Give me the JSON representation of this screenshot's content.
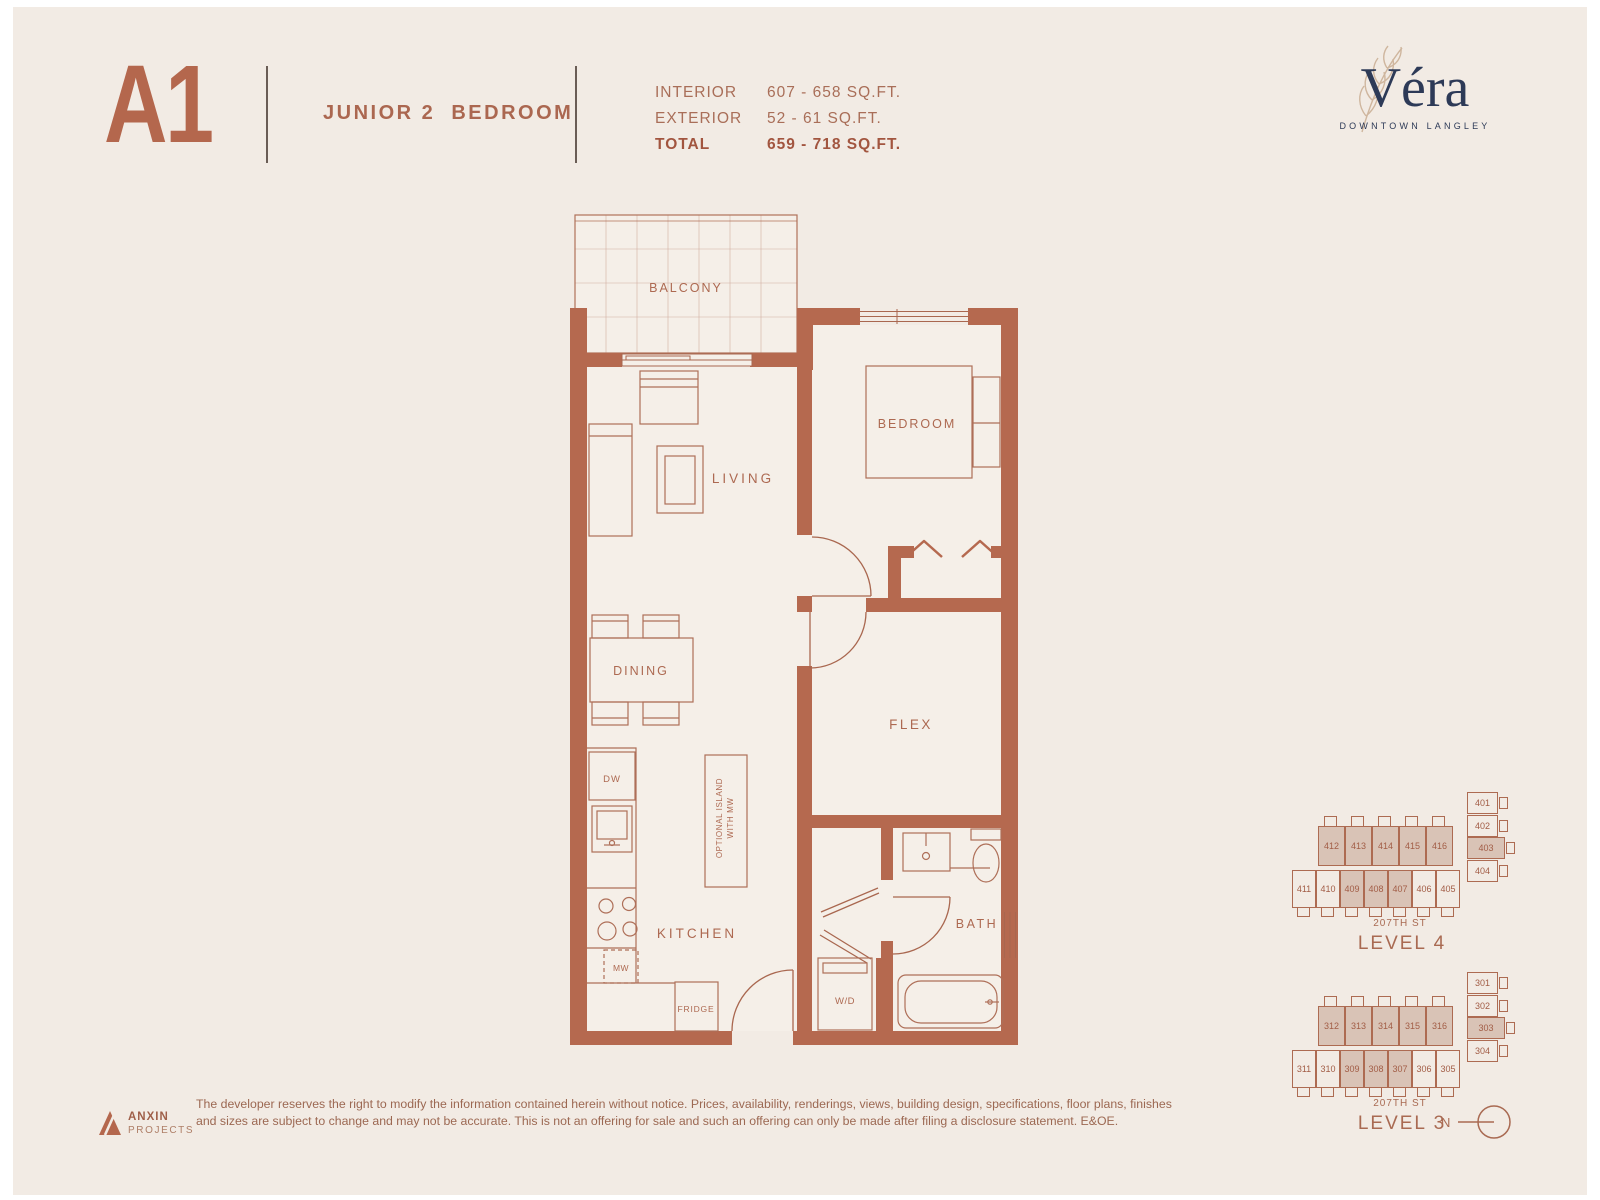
{
  "header": {
    "plan_code": "A1",
    "plan_type": "JUNIOR 2  BEDROOM",
    "areas": [
      {
        "label": "INTERIOR",
        "value": "607 - 658  SQ.FT."
      },
      {
        "label": "EXTERIOR",
        "value": "52 - 61  SQ.FT."
      },
      {
        "label": "TOTAL",
        "value": "659 - 718  SQ.FT."
      }
    ]
  },
  "brand": {
    "name": "Véra",
    "tagline": "DOWNTOWN LANGLEY"
  },
  "colors": {
    "accent_terracotta": "#b5694f",
    "navy": "#2d3a57",
    "unit_shade": "#d9c3b6",
    "background": "#f2ebe4"
  },
  "floorplan": {
    "labels": {
      "balcony": "BALCONY",
      "living": "LIVING",
      "bedroom": "BEDROOM",
      "dining": "DINING",
      "flex": "FLEX",
      "kitchen": "KITCHEN",
      "bath": "BATH",
      "dishwasher": "DW",
      "microwave": "MW",
      "fridge": "FRIDGE",
      "washer_dryer": "W/D",
      "island_line1": "OPTIONAL ISLAND",
      "island_line2": "WITH MW"
    }
  },
  "keyplans": [
    {
      "level": "LEVEL 4",
      "street": "207TH ST",
      "top_row": [
        {
          "num": "412",
          "shaded": true
        },
        {
          "num": "413",
          "shaded": true
        },
        {
          "num": "414",
          "shaded": true
        },
        {
          "num": "415",
          "shaded": true
        },
        {
          "num": "416",
          "shaded": true
        }
      ],
      "right_col": [
        {
          "num": "401",
          "shaded": false
        },
        {
          "num": "402",
          "shaded": false
        },
        {
          "num": "403",
          "shaded": true
        },
        {
          "num": "404",
          "shaded": false
        }
      ],
      "bottom_row": [
        {
          "num": "411",
          "shaded": false
        },
        {
          "num": "410",
          "shaded": false
        },
        {
          "num": "409",
          "shaded": true
        },
        {
          "num": "408",
          "shaded": true
        },
        {
          "num": "407",
          "shaded": true
        },
        {
          "num": "406",
          "shaded": false
        },
        {
          "num": "405",
          "shaded": false
        }
      ]
    },
    {
      "level": "LEVEL 3",
      "street": "207TH ST",
      "top_row": [
        {
          "num": "312",
          "shaded": true
        },
        {
          "num": "313",
          "shaded": true
        },
        {
          "num": "314",
          "shaded": true
        },
        {
          "num": "315",
          "shaded": true
        },
        {
          "num": "316",
          "shaded": true
        }
      ],
      "right_col": [
        {
          "num": "301",
          "shaded": false
        },
        {
          "num": "302",
          "shaded": false
        },
        {
          "num": "303",
          "shaded": true
        },
        {
          "num": "304",
          "shaded": false
        }
      ],
      "bottom_row": [
        {
          "num": "311",
          "shaded": false
        },
        {
          "num": "310",
          "shaded": false
        },
        {
          "num": "309",
          "shaded": true
        },
        {
          "num": "308",
          "shaded": true
        },
        {
          "num": "307",
          "shaded": true
        },
        {
          "num": "306",
          "shaded": false
        },
        {
          "num": "305",
          "shaded": false
        }
      ]
    }
  ],
  "compass": {
    "label": "N"
  },
  "footer": {
    "logo_name": "ANXIN",
    "logo_sub": "PROJECTS",
    "disclaimer_line1": "The developer reserves the right to modify the information contained herein without notice. Prices, availability, renderings, views, building design, specifications, floor plans, finishes",
    "disclaimer_line2": "and sizes are subject to change and may not be accurate. This is not an offering for sale and such an offering can only be made after filing a disclosure statement. E&OE."
  }
}
